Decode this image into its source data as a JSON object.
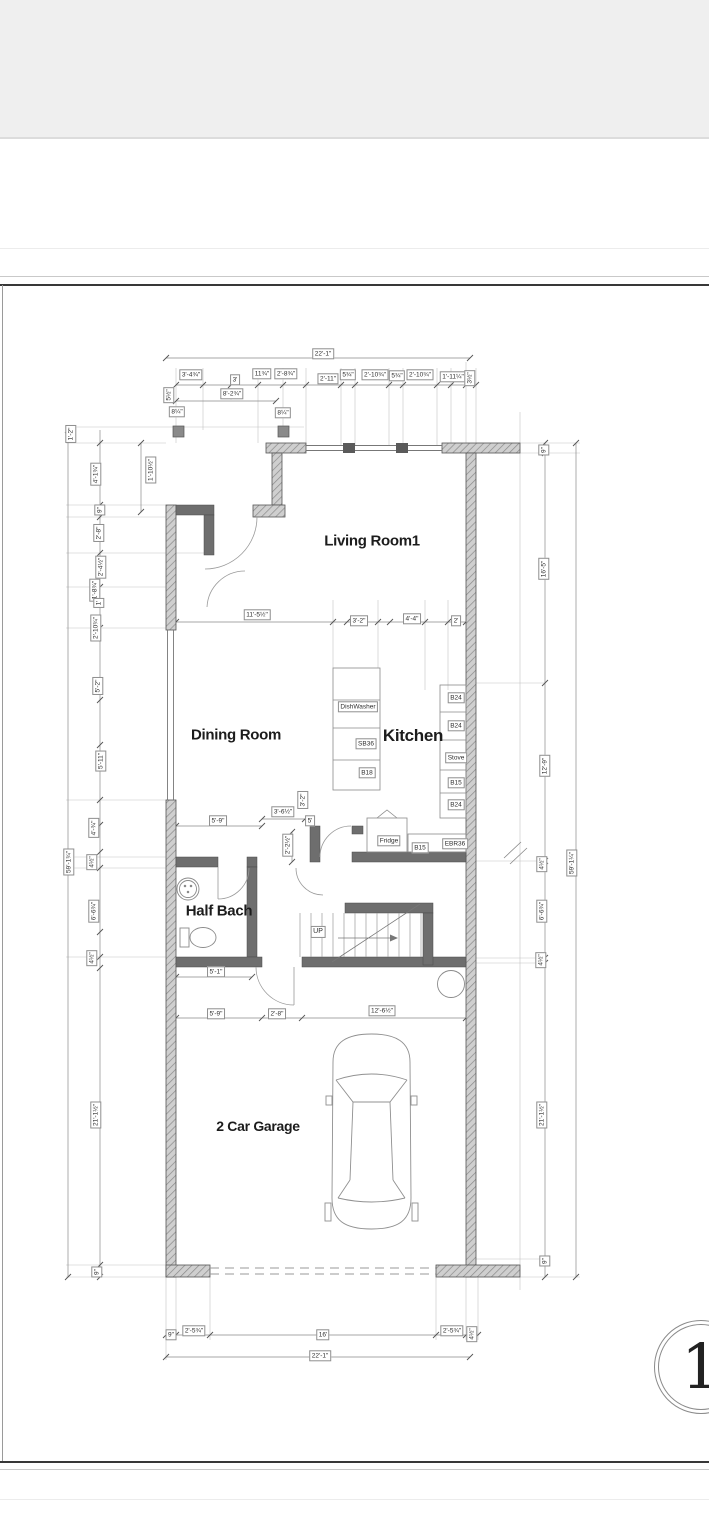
{
  "plan": {
    "sheet_number": "1",
    "rooms": {
      "living": "Living Room1",
      "dining": "Dining Room",
      "kitchen": "Kitchen",
      "half_bath": "Half Bach",
      "garage": "2 Car Garage"
    },
    "stairs": {
      "up": "UP"
    },
    "appliances": {
      "dishwasher": "DishWasher",
      "sink_base": "SB36",
      "base18": "B18",
      "b24_1": "B24",
      "b24_2": "B24",
      "stove": "Stove",
      "b15_1": "B15",
      "b24_3": "B24",
      "fridge": "Fridge",
      "b15_2": "B15",
      "corner_cab": "EBR36"
    },
    "dims": {
      "top": [
        "22'-1\"",
        "3'-4¾\"",
        "3'",
        "11¾\"",
        "2'-8¾\"",
        "2'-11\"",
        "5¾\"",
        "2'-10¾\"",
        "5¾\"",
        "2'-10¾\"",
        "1'-11¼\"",
        "3½\"",
        "8'-2¾\"",
        "5½\"",
        "8¼\"",
        "8¼\""
      ],
      "left": [
        "1'-2\"",
        "4'-1¾\"",
        "1'-10½\"",
        "9\"",
        "2'-8\"",
        "2'-4½\"",
        "1'-8¾\"",
        "1'",
        "2'-10¾\"",
        "5'-2\"",
        "5'-11\"",
        "4'-¾\"",
        "4½\"",
        "59'-1¾\"",
        "6'-6¾\"",
        "4½\"",
        "21'-1½\"",
        "9\""
      ],
      "right": [
        "9\"",
        "16'-5\"",
        "12'-9\"",
        "4½\"",
        "59'-1¼\"",
        "6'-6¾\"",
        "4½\"",
        "21'-1½\"",
        "9\""
      ],
      "mid": [
        "11'-5½\"",
        "3'-2\"",
        "4'-4\"",
        "2'"
      ],
      "inner": [
        "5'-9\"",
        "3'-6½\"",
        "3'-2\"",
        "5'",
        "2'-2½\"",
        "5'-1\""
      ],
      "garage": [
        "5'-9\"",
        "2'-8\"",
        "12'-6½\""
      ],
      "bottom": [
        "9\"",
        "2'-5¾\"",
        "16'",
        "2'-5¾\"",
        "4½\"",
        "22'-1\""
      ]
    }
  }
}
